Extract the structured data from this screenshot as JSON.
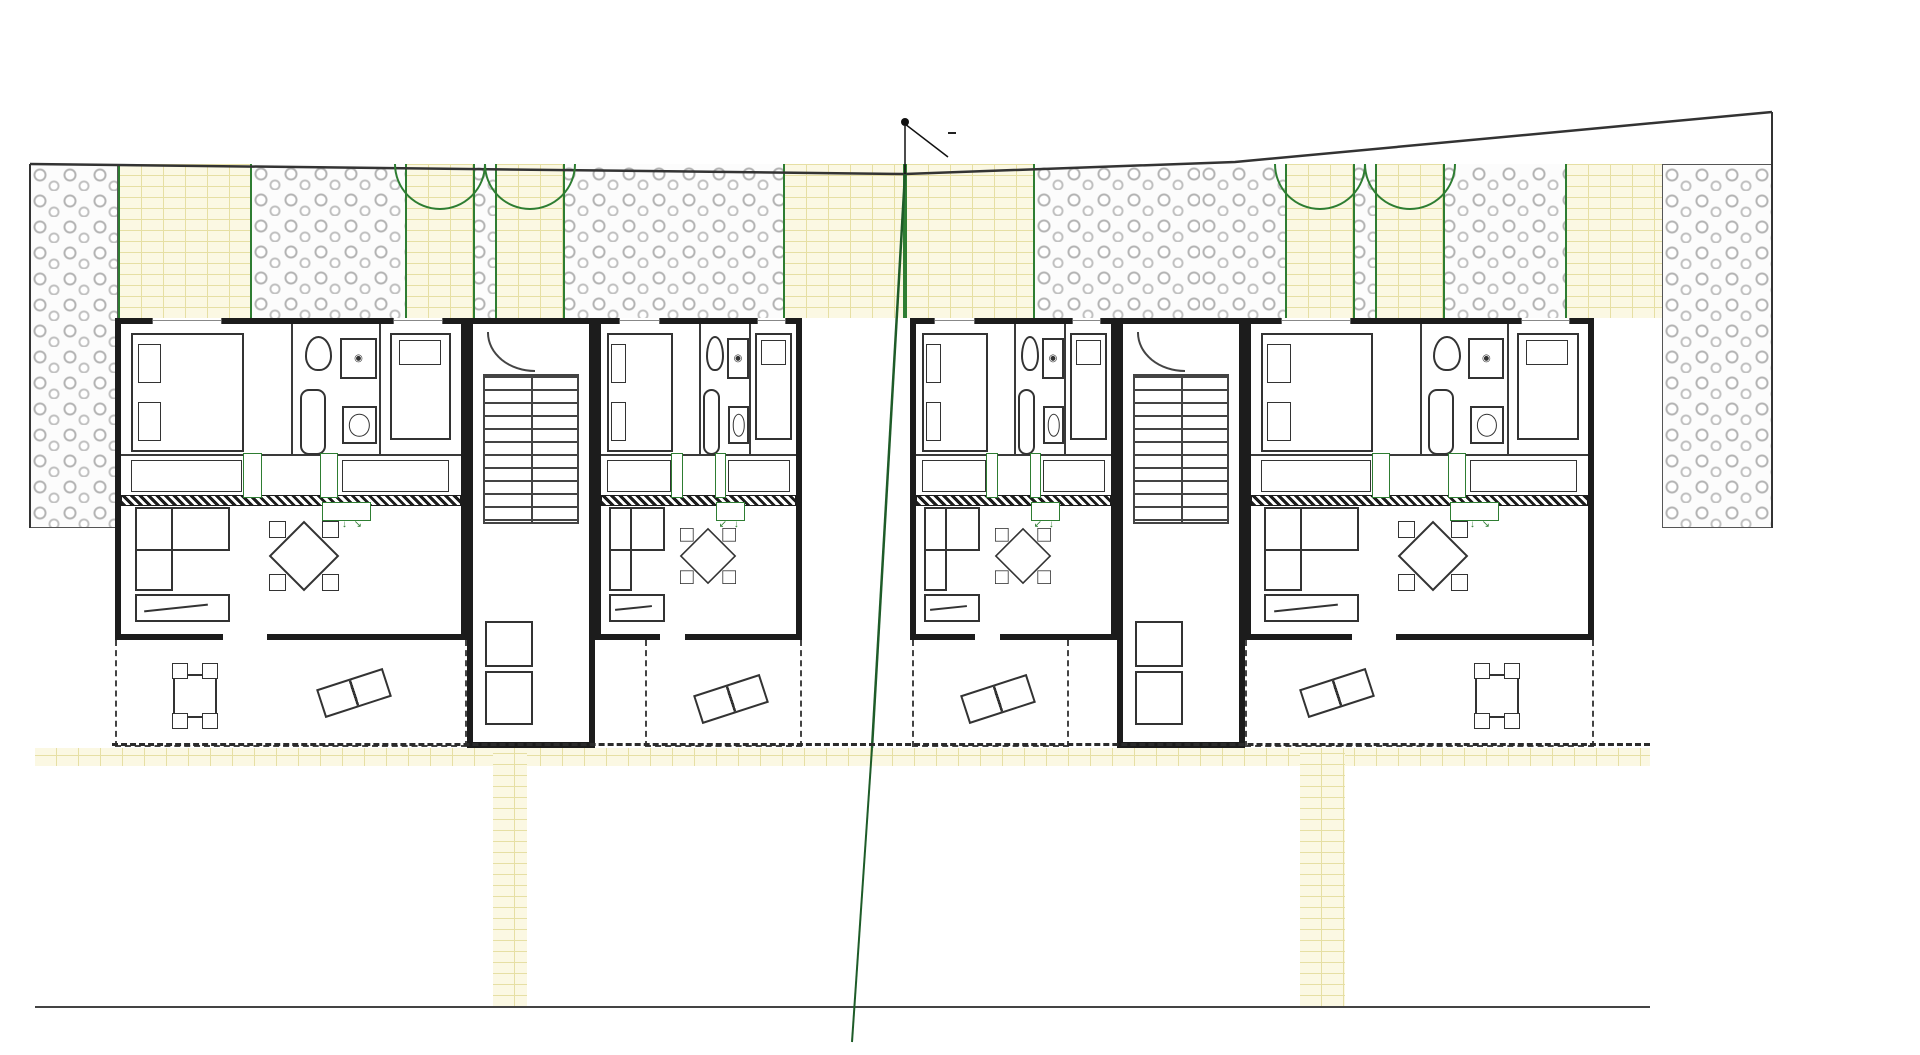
{
  "titles": {
    "building1": "OBJEKT 1",
    "building2": "OBJEKT 2"
  },
  "boundary_label": "MEĐA",
  "garden": {
    "zones": [
      {
        "label": "VRT S4 = 9,7 m2",
        "type": "stone"
      },
      {
        "label": "TERASA S2 = 11,5 m2",
        "type": "brick"
      },
      {
        "label": "VRT S2 = 13,0 m2",
        "type": "stone"
      },
      {
        "label": "VRT S1 = 13,5 m2",
        "type": "stone"
      },
      {
        "label": "TERASA S1 = 11,5 m2",
        "type": "brick"
      },
      {
        "label": "TERASA S2 = 11,5 m2",
        "type": "brick"
      },
      {
        "label": "VRT S2 = 11,0 m2",
        "type": "stone"
      },
      {
        "label": "VRT S1 = 13,5 m2",
        "type": "stone"
      },
      {
        "label": "TERASA S1 = 11,5 m2",
        "type": "brick"
      },
      {
        "label": "VRT S4 = 8,1 m2",
        "type": "stone"
      }
    ],
    "left_side_label": "VRT S3 = 9,7 m2",
    "right_side_label": "VRT S3 = 8,1 m2",
    "tree_label": "MASLINA",
    "trees": [
      {
        "x": 64,
        "y": 212
      },
      {
        "x": 290,
        "y": 195
      },
      {
        "x": 373,
        "y": 278
      },
      {
        "x": 726,
        "y": 202
      },
      {
        "x": 656,
        "y": 280
      },
      {
        "x": 1085,
        "y": 205
      },
      {
        "x": 1042,
        "y": 282
      },
      {
        "x": 1538,
        "y": 207
      },
      {
        "x": 1427,
        "y": 283
      },
      {
        "x": 1750,
        "y": 212
      },
      {
        "x": 52,
        "y": 368
      },
      {
        "x": 50,
        "y": 462
      },
      {
        "x": 1757,
        "y": 350
      },
      {
        "x": 1752,
        "y": 458
      }
    ]
  },
  "apartments": [
    {
      "name": "STAN 2, 4",
      "bedroom1_label": "spavaca soba",
      "bedroom1_area": "9,10 m²",
      "bathroom_label": "kupaona",
      "bathroom_area": "3,63 m²",
      "bedroom2_label": "spavaca soba",
      "bedroom2_area": "8,45 m²",
      "hall_label": "hodnik",
      "hall_area": "1,58 m²",
      "living_label": "d.b.+kuhinja",
      "living_area": "26,10 m²",
      "terrace_label": "terasa",
      "terrace_area": "12,50 m²",
      "wardrobe_label": "ORMAR",
      "ac_label": "KLIMA",
      "shower_label": "TUŠ KADA",
      "shower_size": "80X80"
    },
    {
      "name": "STAN 1, 3",
      "bedroom1_label": "spavaca soba",
      "bedroom1_area": "9,10 m²",
      "bathroom_label": "kupaona",
      "bathroom_area": "3,63 m²",
      "bedroom2_label": "spavaca soba",
      "bedroom2_area": "8,45 m²",
      "hall_label": "hodnik",
      "hall_area": "1,58 m²",
      "living_label": "d.b.+kuhinja",
      "living_area": "26,10 m²",
      "terrace_label": "terasa",
      "terrace_area": "11,65 m²",
      "wardrobe_label": "ORMAR",
      "ac_label": "KLIMA",
      "shower_label": "TUŠ KADA",
      "shower_size": "80X80"
    },
    {
      "name": "STAN 2, 4",
      "bedroom1_label": "spavaca soba",
      "bedroom1_area": "9,10 m²",
      "bathroom_label": "kupaona",
      "bathroom_area": "3,63 m²",
      "bedroom2_label": "spavaca soba",
      "bedroom2_area": "8,45 m²",
      "hall_label": "hodnik",
      "hall_area": "1,58 m²",
      "living_label": "d.b.+kuhinja",
      "living_area": "26,10 m²",
      "terrace_label": "terasa",
      "terrace_area": "11,65 m²",
      "wardrobe_label": "ORMAR",
      "ac_label": "KLIMA",
      "shower_label": "TUŠ KADA",
      "shower_size": "80X80"
    },
    {
      "name": "STAN 1, 3",
      "bedroom1_label": "spavaca soba",
      "bedroom1_area": "9,10 m²",
      "bathroom_label": "kupaona",
      "bathroom_area": "3,63 m²",
      "bedroom2_label": "spavaca soba",
      "bedroom2_area": "8,45 m²",
      "hall_label": "hodnik",
      "hall_area": "1,58 m²",
      "living_label": "d.b.+kuhinja",
      "living_area": "26,10 m²",
      "terrace_label": "terasa",
      "terrace_area": "12,50 m²",
      "wardrobe_label": "ORMAR",
      "ac_label": "KLIMA",
      "shower_label": "TUŠ KADA",
      "shower_size": "80X80"
    }
  ],
  "staircases": [
    {
      "label": "stubišni prostor",
      "area": "13,50 m²"
    },
    {
      "label": "stubišni prostor",
      "area": "13,50 m²"
    }
  ],
  "parking": {
    "groups": [
      {
        "x": 35,
        "stalls": 4,
        "pitch": 114.5
      },
      {
        "x": 527,
        "stalls": 8,
        "pitch": 96.6
      },
      {
        "x": 1345,
        "stalls": 4,
        "pitch": 76.25
      }
    ]
  },
  "watermark": "ADRIA"
}
